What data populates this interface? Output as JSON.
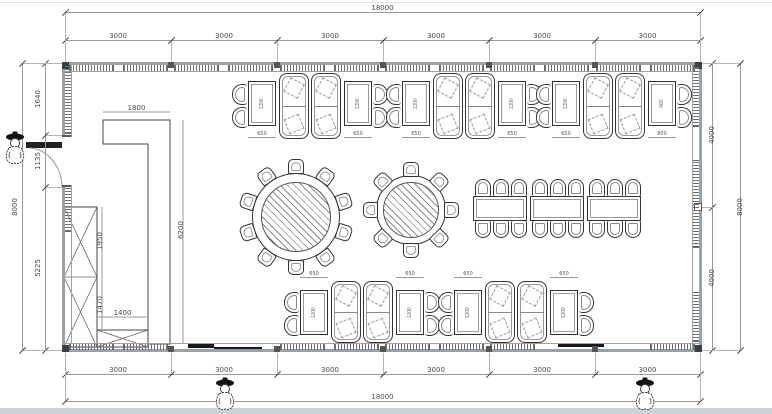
{
  "dims": {
    "top_overall": "18000",
    "top_segments": [
      "3000",
      "3000",
      "3000",
      "3000",
      "3000",
      "3000"
    ],
    "bottom_segments": [
      "3000",
      "3000",
      "3000",
      "3000",
      "3000",
      "3000"
    ],
    "bottom_overall": "18000",
    "left_overall": "8000",
    "left_segments": [
      "1640",
      "1135",
      "5225"
    ],
    "right_segments": [
      "4000",
      "4000"
    ],
    "right_overall": "8000",
    "counter_width": "1800",
    "counter_length": "6200",
    "cabinet_upper_height": "1950",
    "cabinet_lower_height": "1470",
    "cabinet_small_width": "1400",
    "booth_table_width": "650",
    "booth_table_depth": "1200",
    "end_table_width": "800",
    "end_table_depth": "600"
  },
  "furniture": {
    "round_table_large": {
      "seats": 10
    },
    "round_table_small": {
      "seats": 8
    },
    "banquet": {
      "tables": 3,
      "chairs_per_table_side": 3
    },
    "booth_groups_top": 3,
    "booth_groups_bottom": 2,
    "persons": 3
  },
  "colors": {
    "line": "#333333",
    "wall": "#9aa1a7",
    "dim_line": "#8a8a8a",
    "dim_text": "#4a4a4a",
    "hatch": "#707070"
  }
}
